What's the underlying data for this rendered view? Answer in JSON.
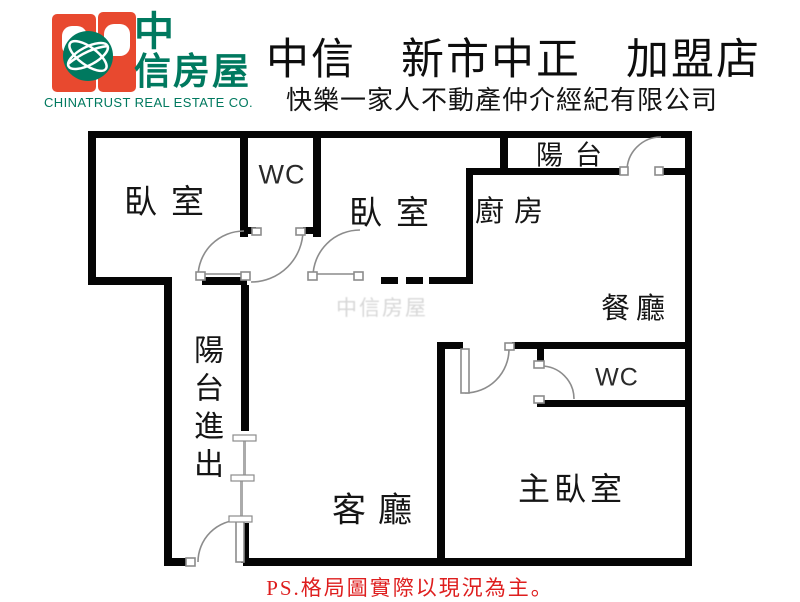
{
  "header": {
    "logo": {
      "brand_zh_line1": "中",
      "brand_zh_line2": "信房屋",
      "company_en": "CHINATRUST REAL ESTATE CO."
    },
    "store_title": "中信　新市中正　加盟店",
    "subtitle": "快樂一家人不動產仲介經紀有限公司"
  },
  "floor_plan": {
    "watermark": "中信房屋",
    "rooms": {
      "bedroom_top_left": {
        "label": "臥室"
      },
      "wc_top": {
        "label": "WC"
      },
      "bedroom_middle": {
        "label": "臥室"
      },
      "kitchen": {
        "label": "廚房"
      },
      "balcony_top": {
        "label": "陽台"
      },
      "dining": {
        "label": "餐廳"
      },
      "wc_right": {
        "label": "WC"
      },
      "master_bedroom": {
        "label": "主臥室"
      },
      "living_room": {
        "label": "客廳"
      },
      "balcony_access": {
        "label": "陽台進出"
      }
    }
  },
  "footer": {
    "note": "PS.格局圖實際以現況為主。"
  },
  "colors": {
    "brand_green": "#00795f",
    "brand_orange": "#e8492f",
    "note_red": "#de1e1e",
    "wall_black": "#000000",
    "door_gray": "#8c8c8c"
  }
}
